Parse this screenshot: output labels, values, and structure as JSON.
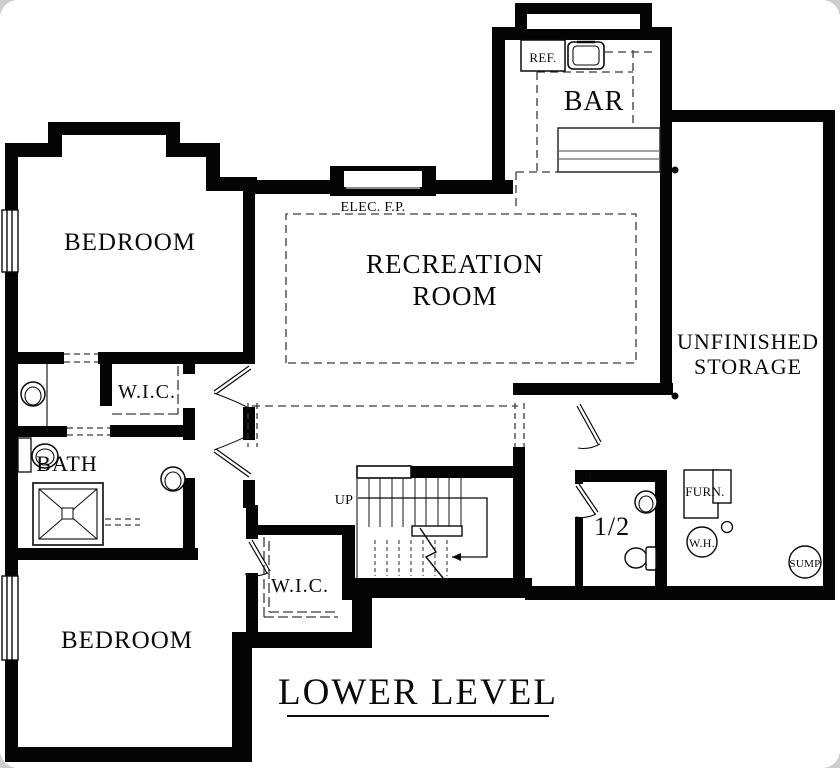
{
  "title": {
    "text": "LOWER LEVEL"
  },
  "rooms": {
    "bedroom_upper": "BEDROOM",
    "bedroom_lower": "BEDROOM",
    "recreation_line1": "RECREATION",
    "recreation_line2": "ROOM",
    "bar": "BAR",
    "unfinished_line1": "UNFINISHED",
    "unfinished_line2": "STORAGE",
    "wic_upper": "W.I.C.",
    "wic_lower": "W.I.C.",
    "bath": "BATH",
    "half_bath": "1/2"
  },
  "annotations": {
    "refrigerator": "REF.",
    "electric_fireplace": "ELEC. F.P.",
    "stairs_up": "UP",
    "furnace": "FURN.",
    "water_heater": "W.H.",
    "sump_pump": "SUMP"
  },
  "colors": {
    "wall": "#050505",
    "background": "#ffffff",
    "thin_line": "#2a2a2a",
    "page_behind": "#cdcdcd"
  }
}
